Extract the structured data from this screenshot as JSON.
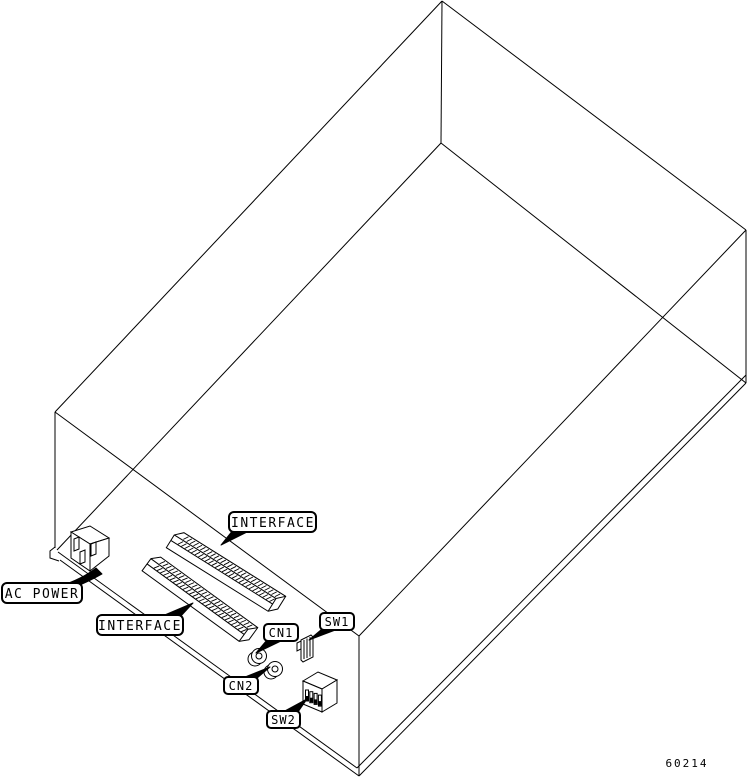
{
  "figure": {
    "part_number": "60214",
    "colors": {
      "line": "#000000",
      "background": "#ffffff",
      "label_fill": "#ffffff",
      "label_text": "#000000"
    }
  },
  "callouts": {
    "interface_top": "INTERFACE",
    "ac_power": "AC POWER",
    "interface_bottom": "INTERFACE",
    "cn1": "CN1",
    "sw1": "SW1",
    "cn2": "CN2",
    "sw2": "SW2"
  }
}
